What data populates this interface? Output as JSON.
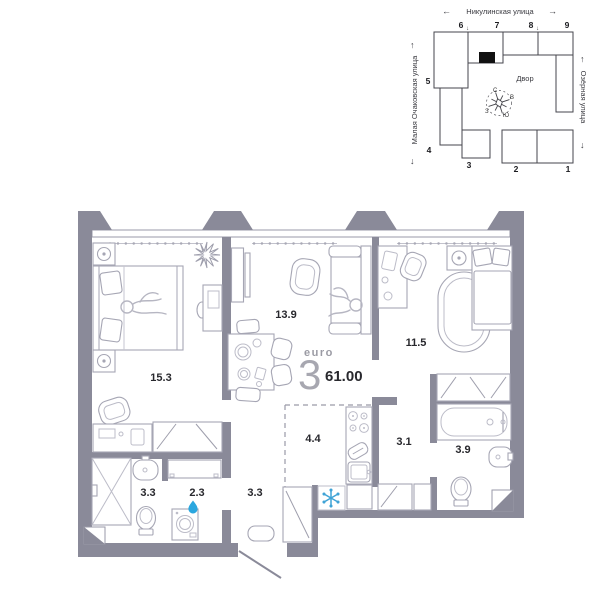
{
  "site_map": {
    "street_top": "Никулинская улица",
    "street_left": "Малая Очаковская улица",
    "street_right": "Озёрная улица",
    "courtyard_label": "Двор",
    "building_numbers": [
      "1",
      "2",
      "3",
      "4",
      "5",
      "6",
      "7",
      "8",
      "9"
    ],
    "compass": {
      "north": "С",
      "east": "В",
      "west": "З",
      "south": "Ю"
    },
    "arrow_left": "←",
    "arrow_right": "→",
    "arrow_up": "↑",
    "arrow_down": "↓",
    "highlight_color": "#e2e2e5",
    "unit_marker_color": "#111111"
  },
  "plan": {
    "type_label": "euro",
    "rooms_count": "3",
    "total_area": "61.00",
    "rooms": [
      {
        "name": "bedroom",
        "area": "15.3"
      },
      {
        "name": "living-room",
        "area": "13.9"
      },
      {
        "name": "bedroom-2",
        "area": "11.5"
      },
      {
        "name": "kitchen",
        "area": "4.4"
      },
      {
        "name": "hallway",
        "area": "3.1"
      },
      {
        "name": "bathroom",
        "area": "3.9"
      },
      {
        "name": "shower-room",
        "area": "3.3"
      },
      {
        "name": "laundry",
        "area": "2.3"
      },
      {
        "name": "entrance-hall",
        "area": "3.3"
      }
    ],
    "colors": {
      "wall": "#8a8a99",
      "furniture": "#a6a6b4",
      "accent_blue": "#3fa3d6",
      "drop_blue": "#2ba7df",
      "text": "#28282d",
      "muted": "#9b9ba4"
    }
  }
}
